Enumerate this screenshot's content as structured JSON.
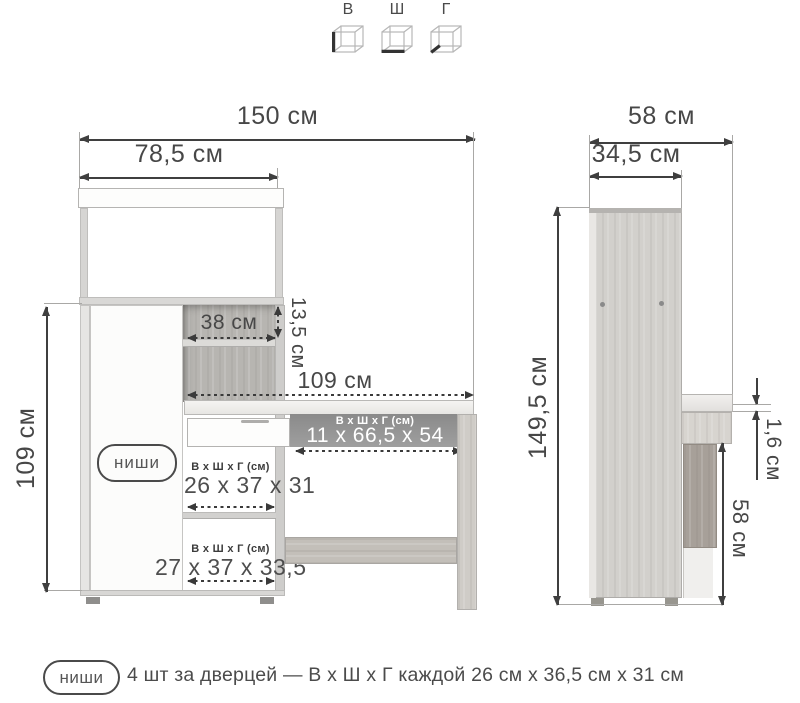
{
  "legend": {
    "height_label": "В",
    "width_label": "Ш",
    "depth_label": "Г"
  },
  "front_view": {
    "total_width": "150 см",
    "hutch_width": "78,5 см",
    "cabinet_height": "109 см",
    "upper_niche_width": "38 см",
    "upper_niche_height": "13,5 см",
    "desk_width": "109 см",
    "door_badge": "ниши",
    "under_desk_niche": {
      "header": "В х Ш х Г (см)",
      "size": "11 х 66,5 х 54"
    },
    "door_niche_1": {
      "header": "В х Ш х Г (см)",
      "size": "26 х 37 х 31"
    },
    "door_niche_2": {
      "header": "В х Ш х Г (см)",
      "size": "27 х 37 х 33,5"
    }
  },
  "side_view": {
    "total_depth": "58 см",
    "upper_depth": "34,5 см",
    "total_height": "149,5 см",
    "top_thickness": "1,6 см",
    "under_desk_height": "58 см"
  },
  "footnote": {
    "badge": "ниши",
    "text": "4 шт за дверцей — В х Ш х Г каждой 26 см х 36,5 см х 31 см"
  },
  "colors": {
    "dimension": "#3f3f3f",
    "wood_light": "#d2d0cc",
    "wood_medium": "#b7b5b1",
    "wood_dark": "#a7a099",
    "niche_gray": "#949494"
  }
}
